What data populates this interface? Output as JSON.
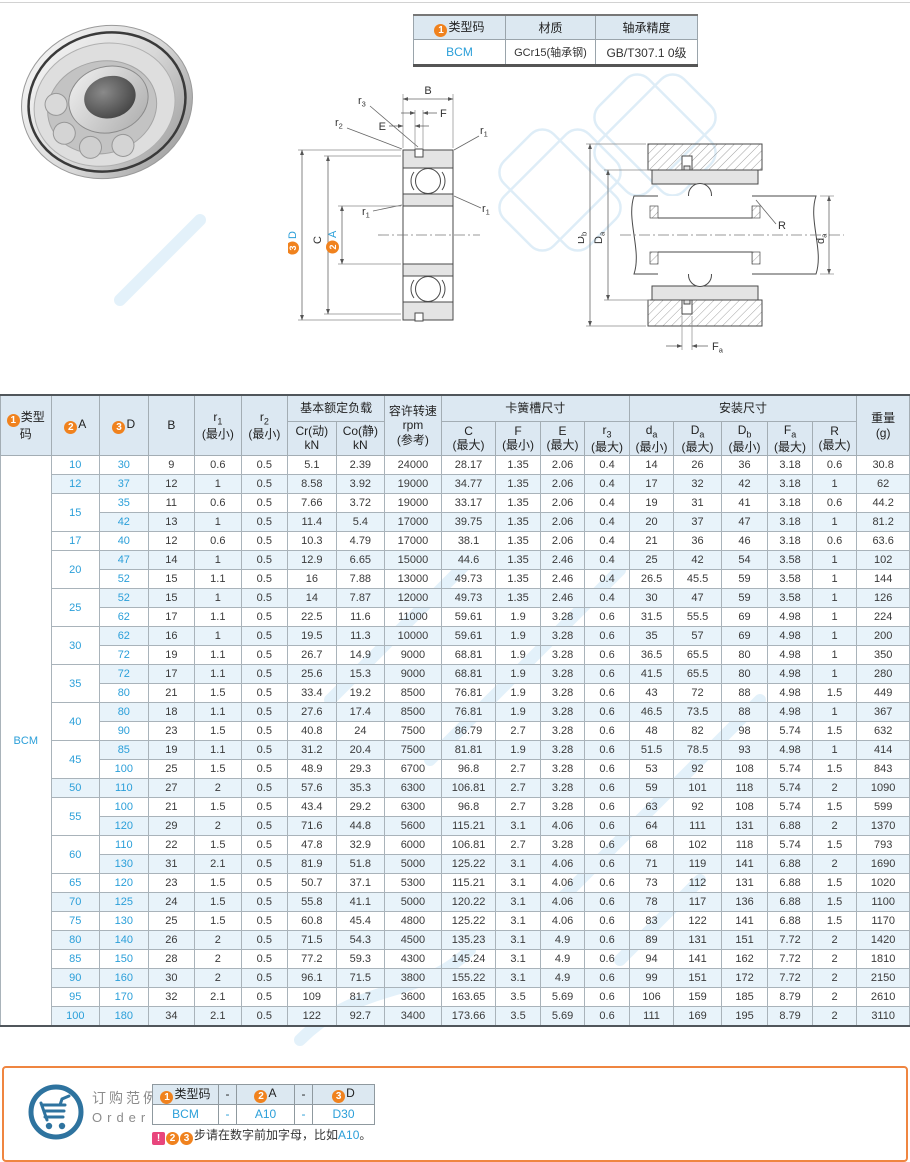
{
  "spec_table": {
    "badge1": "1",
    "col_type": "类型码",
    "col_material": "材质",
    "col_precision": "轴承精度",
    "type_code": "BCM",
    "material": "GCr15(轴承钢)",
    "precision": "GB/T307.1 0级"
  },
  "drawing_mid": {
    "B": "B",
    "E": "E",
    "F": "F",
    "C": "C",
    "r": "r",
    "s1": "1",
    "s2": "2",
    "s3": "3",
    "badge2": "2",
    "A": "A",
    "badge3": "3",
    "D": "D"
  },
  "drawing_right": {
    "D": "D",
    "d": "d",
    "R": "R",
    "F": "F",
    "sa": "a",
    "sb": "b"
  },
  "main_table": {
    "type_code": "BCM",
    "col_type": {
      "badge": "1",
      "label": "类型码"
    },
    "col_a": {
      "badge": "2",
      "label": "A"
    },
    "col_d": {
      "badge": "3",
      "label": "D"
    },
    "col_b": "B",
    "col_r1": {
      "n": "r",
      "s": "1",
      "q": "(最小)"
    },
    "col_r2": {
      "n": "r",
      "s": "2",
      "q": "(最小)"
    },
    "grp_load": "基本额定负载",
    "col_cr": {
      "l1": "Cr(动)",
      "l2": "kN"
    },
    "col_co": {
      "l1": "Co(静)",
      "l2": "kN"
    },
    "col_rpm": {
      "l1": "容许转速",
      "l2": "rpm",
      "l3": "(参考)"
    },
    "grp_ring": "卡簧槽尺寸",
    "col_c": {
      "n": "C",
      "q": "(最大)"
    },
    "col_f": {
      "n": "F",
      "q": "(最小)"
    },
    "col_e": {
      "n": "E",
      "q": "(最大)"
    },
    "col_r3": {
      "n": "r",
      "s": "3",
      "q": "(最大)"
    },
    "grp_mount": "安装尺寸",
    "col_da": {
      "n": "d",
      "s": "a",
      "q": "(最小)"
    },
    "col_Da": {
      "n": "D",
      "s": "a",
      "q": "(最大)"
    },
    "col_Db": {
      "n": "D",
      "s": "b",
      "q": "(最小)"
    },
    "col_Fa": {
      "n": "F",
      "s": "a",
      "q": "(最大)"
    },
    "col_R": {
      "n": "R",
      "q": "(最大)"
    },
    "col_w": {
      "l1": "重量",
      "l2": "(g)"
    },
    "rows": [
      [
        "10",
        "30",
        "9",
        "0.6",
        "0.5",
        "5.1",
        "2.39",
        "24000",
        "28.17",
        "1.35",
        "2.06",
        "0.4",
        "14",
        "26",
        "36",
        "3.18",
        "0.6",
        "30.8"
      ],
      [
        "12",
        "37",
        "12",
        "1",
        "0.5",
        "8.58",
        "3.92",
        "19000",
        "34.77",
        "1.35",
        "2.06",
        "0.4",
        "17",
        "32",
        "42",
        "3.18",
        "1",
        "62"
      ],
      [
        "15",
        "35",
        "11",
        "0.6",
        "0.5",
        "7.66",
        "3.72",
        "19000",
        "33.17",
        "1.35",
        "2.06",
        "0.4",
        "19",
        "31",
        "41",
        "3.18",
        "0.6",
        "44.2"
      ],
      [
        null,
        "42",
        "13",
        "1",
        "0.5",
        "11.4",
        "5.4",
        "17000",
        "39.75",
        "1.35",
        "2.06",
        "0.4",
        "20",
        "37",
        "47",
        "3.18",
        "1",
        "81.2"
      ],
      [
        "17",
        "40",
        "12",
        "0.6",
        "0.5",
        "10.3",
        "4.79",
        "17000",
        "38.1",
        "1.35",
        "2.06",
        "0.4",
        "21",
        "36",
        "46",
        "3.18",
        "0.6",
        "63.6"
      ],
      [
        "20",
        "47",
        "14",
        "1",
        "0.5",
        "12.9",
        "6.65",
        "15000",
        "44.6",
        "1.35",
        "2.46",
        "0.4",
        "25",
        "42",
        "54",
        "3.58",
        "1",
        "102"
      ],
      [
        null,
        "52",
        "15",
        "1.1",
        "0.5",
        "16",
        "7.88",
        "13000",
        "49.73",
        "1.35",
        "2.46",
        "0.4",
        "26.5",
        "45.5",
        "59",
        "3.58",
        "1",
        "144"
      ],
      [
        "25",
        "52",
        "15",
        "1",
        "0.5",
        "14",
        "7.87",
        "12000",
        "49.73",
        "1.35",
        "2.46",
        "0.4",
        "30",
        "47",
        "59",
        "3.58",
        "1",
        "126"
      ],
      [
        null,
        "62",
        "17",
        "1.1",
        "0.5",
        "22.5",
        "11.6",
        "11000",
        "59.61",
        "1.9",
        "3.28",
        "0.6",
        "31.5",
        "55.5",
        "69",
        "4.98",
        "1",
        "224"
      ],
      [
        "30",
        "62",
        "16",
        "1",
        "0.5",
        "19.5",
        "11.3",
        "10000",
        "59.61",
        "1.9",
        "3.28",
        "0.6",
        "35",
        "57",
        "69",
        "4.98",
        "1",
        "200"
      ],
      [
        null,
        "72",
        "19",
        "1.1",
        "0.5",
        "26.7",
        "14.9",
        "9000",
        "68.81",
        "1.9",
        "3.28",
        "0.6",
        "36.5",
        "65.5",
        "80",
        "4.98",
        "1",
        "350"
      ],
      [
        "35",
        "72",
        "17",
        "1.1",
        "0.5",
        "25.6",
        "15.3",
        "9000",
        "68.81",
        "1.9",
        "3.28",
        "0.6",
        "41.5",
        "65.5",
        "80",
        "4.98",
        "1",
        "280"
      ],
      [
        null,
        "80",
        "21",
        "1.5",
        "0.5",
        "33.4",
        "19.2",
        "8500",
        "76.81",
        "1.9",
        "3.28",
        "0.6",
        "43",
        "72",
        "88",
        "4.98",
        "1.5",
        "449"
      ],
      [
        "40",
        "80",
        "18",
        "1.1",
        "0.5",
        "27.6",
        "17.4",
        "8500",
        "76.81",
        "1.9",
        "3.28",
        "0.6",
        "46.5",
        "73.5",
        "88",
        "4.98",
        "1",
        "367"
      ],
      [
        null,
        "90",
        "23",
        "1.5",
        "0.5",
        "40.8",
        "24",
        "7500",
        "86.79",
        "2.7",
        "3.28",
        "0.6",
        "48",
        "82",
        "98",
        "5.74",
        "1.5",
        "632"
      ],
      [
        "45",
        "85",
        "19",
        "1.1",
        "0.5",
        "31.2",
        "20.4",
        "7500",
        "81.81",
        "1.9",
        "3.28",
        "0.6",
        "51.5",
        "78.5",
        "93",
        "4.98",
        "1",
        "414"
      ],
      [
        null,
        "100",
        "25",
        "1.5",
        "0.5",
        "48.9",
        "29.3",
        "6700",
        "96.8",
        "2.7",
        "3.28",
        "0.6",
        "53",
        "92",
        "108",
        "5.74",
        "1.5",
        "843"
      ],
      [
        "50",
        "110",
        "27",
        "2",
        "0.5",
        "57.6",
        "35.3",
        "6300",
        "106.81",
        "2.7",
        "3.28",
        "0.6",
        "59",
        "101",
        "118",
        "5.74",
        "2",
        "1090"
      ],
      [
        "55",
        "100",
        "21",
        "1.5",
        "0.5",
        "43.4",
        "29.2",
        "6300",
        "96.8",
        "2.7",
        "3.28",
        "0.6",
        "63",
        "92",
        "108",
        "5.74",
        "1.5",
        "599"
      ],
      [
        null,
        "120",
        "29",
        "2",
        "0.5",
        "71.6",
        "44.8",
        "5600",
        "115.21",
        "3.1",
        "4.06",
        "0.6",
        "64",
        "111",
        "131",
        "6.88",
        "2",
        "1370"
      ],
      [
        "60",
        "110",
        "22",
        "1.5",
        "0.5",
        "47.8",
        "32.9",
        "6000",
        "106.81",
        "2.7",
        "3.28",
        "0.6",
        "68",
        "102",
        "118",
        "5.74",
        "1.5",
        "793"
      ],
      [
        null,
        "130",
        "31",
        "2.1",
        "0.5",
        "81.9",
        "51.8",
        "5000",
        "125.22",
        "3.1",
        "4.06",
        "0.6",
        "71",
        "119",
        "141",
        "6.88",
        "2",
        "1690"
      ],
      [
        "65",
        "120",
        "23",
        "1.5",
        "0.5",
        "50.7",
        "37.1",
        "5300",
        "115.21",
        "3.1",
        "4.06",
        "0.6",
        "73",
        "112",
        "131",
        "6.88",
        "1.5",
        "1020"
      ],
      [
        "70",
        "125",
        "24",
        "1.5",
        "0.5",
        "55.8",
        "41.1",
        "5000",
        "120.22",
        "3.1",
        "4.06",
        "0.6",
        "78",
        "117",
        "136",
        "6.88",
        "1.5",
        "1100"
      ],
      [
        "75",
        "130",
        "25",
        "1.5",
        "0.5",
        "60.8",
        "45.4",
        "4800",
        "125.22",
        "3.1",
        "4.06",
        "0.6",
        "83",
        "122",
        "141",
        "6.88",
        "1.5",
        "1170"
      ],
      [
        "80",
        "140",
        "26",
        "2",
        "0.5",
        "71.5",
        "54.3",
        "4500",
        "135.23",
        "3.1",
        "4.9",
        "0.6",
        "89",
        "131",
        "151",
        "7.72",
        "2",
        "1420"
      ],
      [
        "85",
        "150",
        "28",
        "2",
        "0.5",
        "77.2",
        "59.3",
        "4300",
        "145.24",
        "3.1",
        "4.9",
        "0.6",
        "94",
        "141",
        "162",
        "7.72",
        "2",
        "1810"
      ],
      [
        "90",
        "160",
        "30",
        "2",
        "0.5",
        "96.1",
        "71.5",
        "3800",
        "155.22",
        "3.1",
        "4.9",
        "0.6",
        "99",
        "151",
        "172",
        "7.72",
        "2",
        "2150"
      ],
      [
        "95",
        "170",
        "32",
        "2.1",
        "0.5",
        "109",
        "81.7",
        "3600",
        "163.65",
        "3.5",
        "5.69",
        "0.6",
        "106",
        "159",
        "185",
        "8.79",
        "2",
        "2610"
      ],
      [
        "100",
        "180",
        "34",
        "2.1",
        "0.5",
        "122",
        "92.7",
        "3400",
        "173.66",
        "3.5",
        "5.69",
        "0.6",
        "111",
        "169",
        "195",
        "8.79",
        "2",
        "3110"
      ]
    ]
  },
  "order": {
    "title_cn": "订购范例",
    "title_en": "Order",
    "h_type": {
      "badge": "1",
      "label": "类型码"
    },
    "h_dash1": "-",
    "h_a": {
      "badge": "2",
      "label": "A"
    },
    "h_dash2": "-",
    "h_d": {
      "badge": "3",
      "label": "D"
    },
    "v_type": "BCM",
    "v_dash1": "-",
    "v_a": "A10",
    "v_dash2": "-",
    "v_d": "D30",
    "note_excl": "!",
    "note_badge2": "2",
    "note_badge3": "3",
    "note_text": "步请在数字前加字母，比如",
    "note_example": "A10",
    "note_period": "。"
  },
  "colors": {
    "accent_blue": "#2b9fd9",
    "badge_orange": "#f0821e",
    "note_pink": "#e8457c",
    "order_border_orange": "#ef8540",
    "header_bg": "#dce8f2",
    "stripe_bg": "#e8f3fa"
  }
}
